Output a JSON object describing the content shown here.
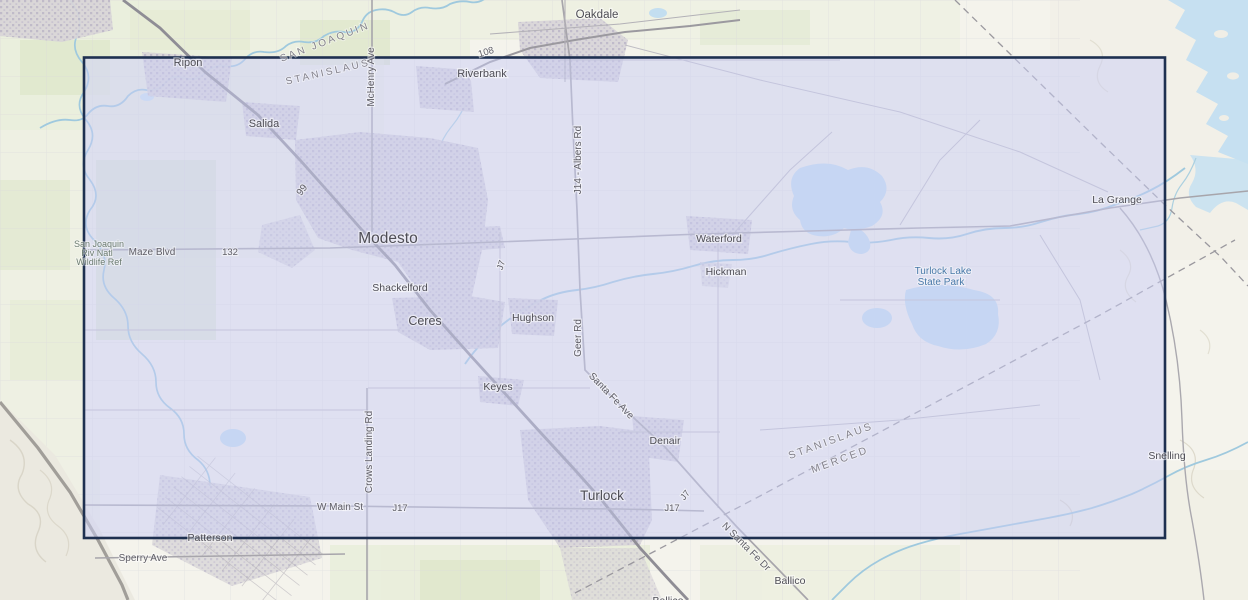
{
  "map": {
    "cities": {
      "oakdale": "Oakdale",
      "ripon": "Ripon",
      "riverbank": "Riverbank",
      "salida": "Salida",
      "modesto": "Modesto",
      "shackelford": "Shackelford",
      "ceres": "Ceres",
      "hughson": "Hughson",
      "keyes": "Keyes",
      "denair": "Denair",
      "turlock": "Turlock",
      "waterford": "Waterford",
      "hickman": "Hickman",
      "la_grange": "La Grange",
      "snelling": "Snelling",
      "patterson": "Patterson",
      "ballico": "Ballico",
      "ballico_south": "Ballico"
    },
    "roads": {
      "mchenry_ave": "McHenry Ave",
      "albers_rd": "J14 - Albers Rd",
      "geer_rd": "Geer Rd",
      "santa_fe_ave": "Santa Fe Ave",
      "crows_landing_rd": "Crows Landing Rd",
      "w_main_st": "W Main St",
      "j17_west": "J17",
      "j17_east": "J17",
      "j7_north": "J7",
      "j7_south": "J7",
      "n_santa_fe_dr": "N Santa Fe Dr",
      "maze_blvd": "Maze Blvd",
      "sperry_ave": "Sperry Ave",
      "route_99": "99",
      "route_108": "108",
      "route_132": "132"
    },
    "counties": {
      "san_joaquin": "SAN JOAQUIN",
      "stanislaus_north": "STANISLAUS",
      "stanislaus_south": "STANISLAUS",
      "merced": "MERCED"
    },
    "places": {
      "wildlife_ref_line1": "San Joaquin",
      "wildlife_ref_line2": "Riv Natl",
      "wildlife_ref_line3": "Wildlife Ref",
      "state_park_line1": "Turlock Lake",
      "state_park_line2": "State Park"
    }
  },
  "selection": {
    "border_color": "#1e3050",
    "fill_color": "rgba(202,205,246,0.5)"
  },
  "colors": {
    "land": "#f4f3ec",
    "water": "#c3def0",
    "farmland": "#e2e9d0",
    "urban": "#d6d3d6",
    "urban_dots": "#bcb6c8",
    "road": "#a7a5ab",
    "highway": "#8f8d95",
    "county_line": "#9a989e"
  }
}
